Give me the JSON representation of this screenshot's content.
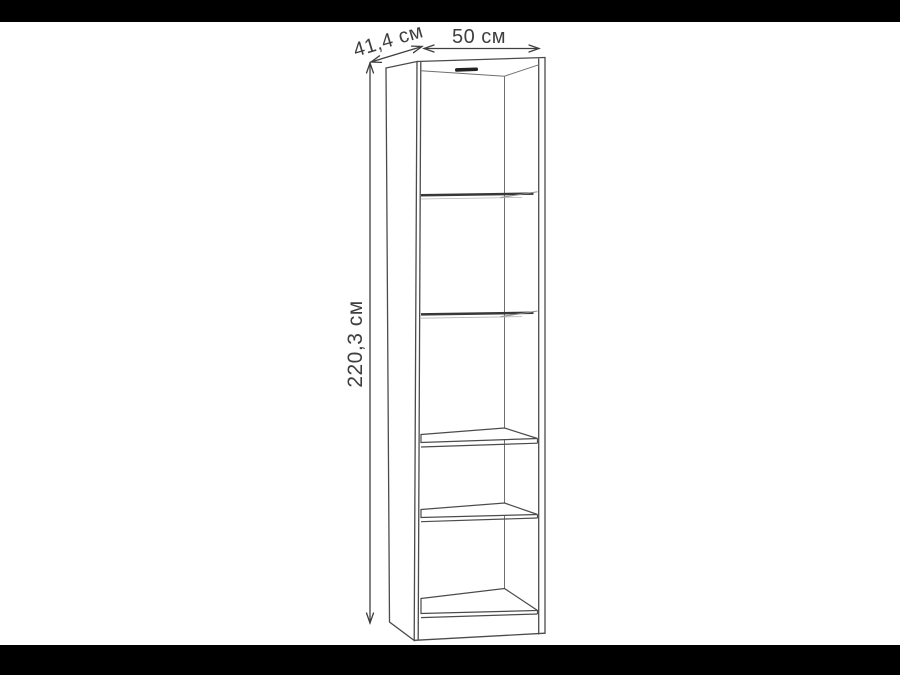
{
  "image": {
    "kind": "product-dimension-diagram",
    "subject": "tall narrow bookcase with five compartments"
  },
  "dimensions": {
    "depth": {
      "label": "41,4 см"
    },
    "width": {
      "label": "50 см"
    },
    "height": {
      "label": "220,3 см"
    }
  },
  "diagram": {
    "compartments": 5,
    "shelves": 4,
    "units": "см"
  },
  "colors": {
    "background": "#ffffff",
    "letterbox": "#000000",
    "outline": "#4b4b4b",
    "shelf_edge_dark": "#383838",
    "label_text": "#3f3f3f",
    "vent_slot": "#222222"
  }
}
